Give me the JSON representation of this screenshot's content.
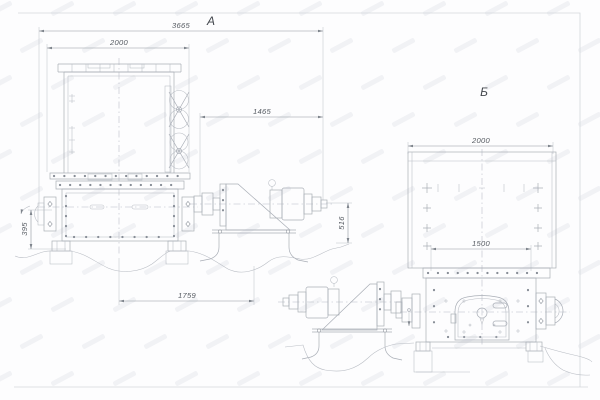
{
  "drawing": {
    "view_a": {
      "label": "А",
      "dim_overall": "3665",
      "dim_top_width": "2000",
      "dim_drive": "1465",
      "dim_base": "1759",
      "dim_height_left": "395",
      "dim_height_right": "516"
    },
    "view_b": {
      "label": "Б",
      "dim_width": "2000",
      "dim_flange": "1500"
    },
    "colors": {
      "line": "#a9aeb6",
      "dimension_text": "#555a61",
      "frame": "#d4d7dc"
    }
  }
}
